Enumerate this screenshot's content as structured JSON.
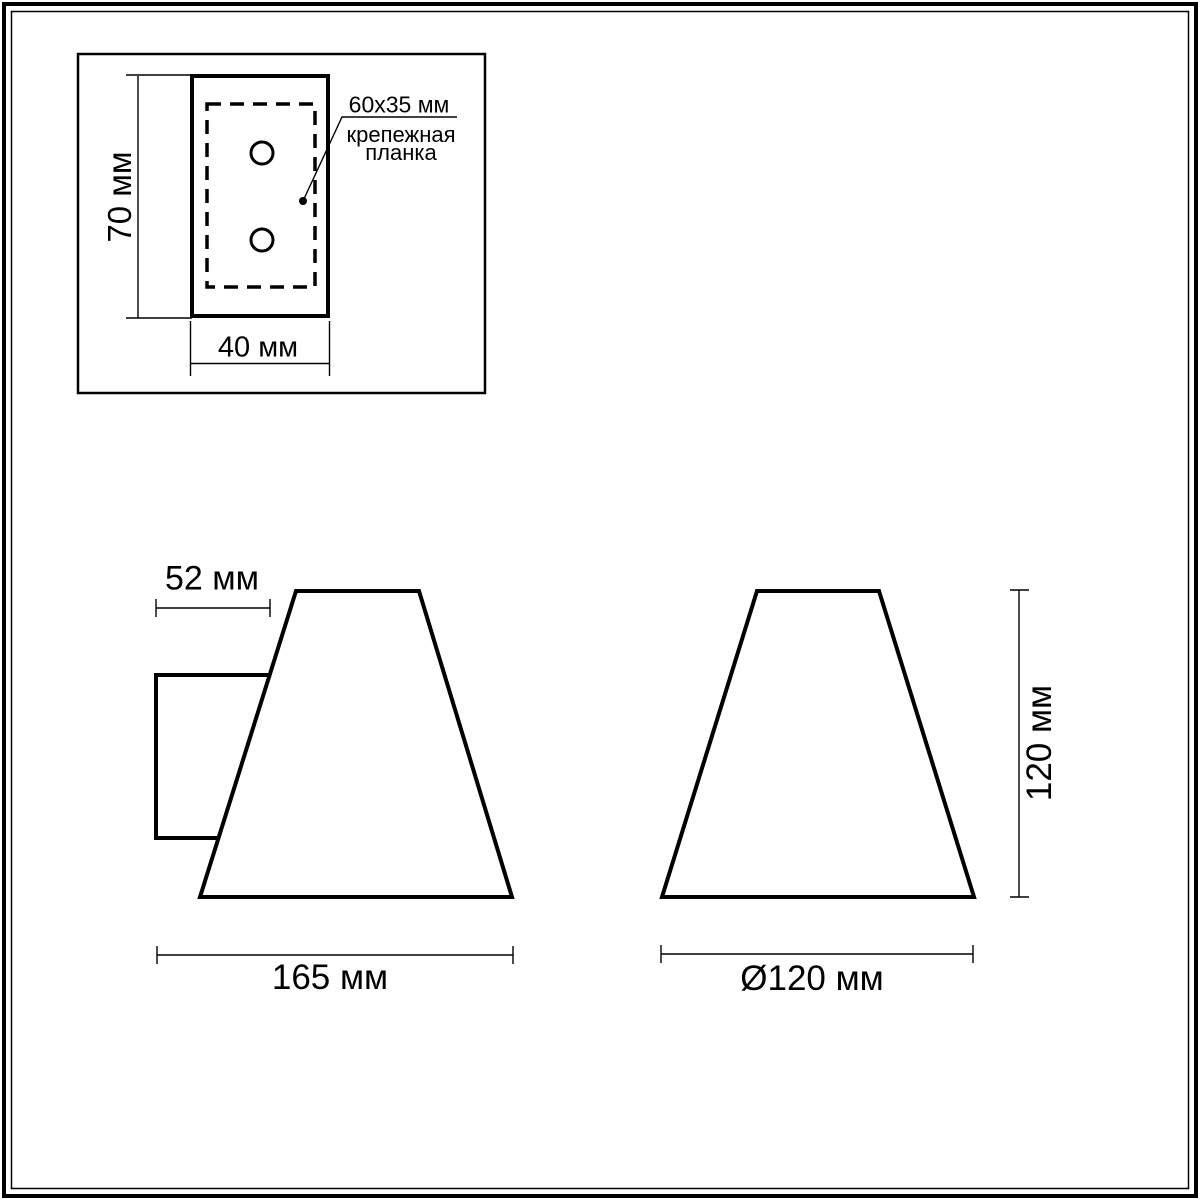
{
  "figure": {
    "colors": {
      "line": "#000000",
      "background": "#ffffff"
    },
    "mounting_plate_inset": {
      "plate_size_label": "60x35 мм",
      "plate_name_line1": "крепежная",
      "plate_name_line2": "планка",
      "height_dim": "70 мм",
      "width_dim": "40 мм"
    },
    "side_view": {
      "depth_dim": "52 мм",
      "width_dim": "165 мм"
    },
    "front_view": {
      "height_dim": "120 мм",
      "diameter_dim": "Ø120 мм"
    }
  }
}
